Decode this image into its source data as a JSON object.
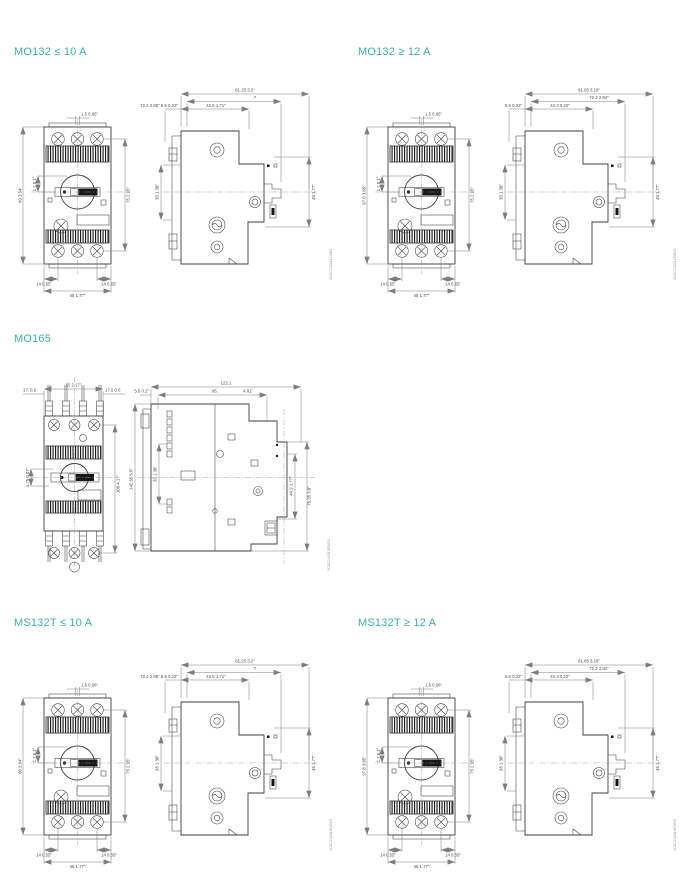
{
  "page": {
    "background": "#ffffff",
    "accent_color": "#2fb4ae",
    "drawing_line_color": "#3d3d3d",
    "dimension_line_color": "#7d7d7d",
    "dimension_text_color": "#4a4a4a"
  },
  "sections": [
    {
      "id": "mo132-le-10a",
      "title": "MO132 ≤ 10 A",
      "doc_number": "2CDC242011F0011",
      "front": {
        "knob_top": "1.5 0.06\"",
        "height_left": "90 3.54\"",
        "knob_offset": "1.7 0.1\"",
        "height_right": "75 2.95\"",
        "foot_left": "14 0.55\"",
        "foot_right": "14  0.55\"",
        "width": "45 1.77\""
      },
      "side": {
        "depth_row1": "81.25 3.2\"",
        "depth_row2": "7",
        "depth_row3_left": "72.4 2.85\" 5.5 0.22\"",
        "depth_row3_right": "43.5 1.71\"",
        "height_left": "35 1.38\"",
        "height_right": "45 1.77\""
      }
    },
    {
      "id": "mo132-ge-12a",
      "title": "MO132 ≥ 12 A",
      "doc_number": "2CDC242012F0011",
      "front": {
        "knob_top": "1.5 0.06\"",
        "height_left": "97.8 3.85\"",
        "knob_offset": "1.7 0.1\"",
        "height_right": "75 2.95\"",
        "foot_left": "14 0.55\"",
        "foot_right": "14  0.55\"",
        "width": "45 1.77\""
      },
      "side": {
        "depth_row1": "81.05 3.19\"",
        "depth_row2": "72.2 2.84\"",
        "depth_row3_left": "5.5 0.22\"",
        "depth_row3_right": "43.3 0.22\"",
        "height_left": "35 1.38\"",
        "height_right": "45 1.77\""
      }
    },
    {
      "id": "mo165",
      "title": "MO165",
      "doc_number": "2CDC242010F0014",
      "front": {
        "top_left": "17. 0.6",
        "top_center": "55 2.17\"",
        "top_right": "17.5 0.6",
        "knob_offset": "1.75 0.07\"",
        "height_right": "106 4.17\""
      },
      "side": {
        "depth_row1": "122.1",
        "depth_row2_left": "95.",
        "depth_row2_right": "4.81\"",
        "clip_top": "5.5 0.2\"",
        "height_left_outer": "142.65 5.6\"",
        "height_left_inner": "35 1.38\"",
        "height_right_inner": "44.9 1.77\"",
        "height_right_outer": "76.35 3.0\""
      }
    },
    {
      "id": "ms132t-le-10a",
      "title": "MS132T ≤ 10 A",
      "doc_number": "2CDC242011F0019",
      "front": {
        "knob_top": "1.5 0.06\"",
        "height_left": "90 3.54\"",
        "knob_offset": "1.7 0.1\"",
        "height_right": "75 2.95\"",
        "foot_left": "14 0.55\"",
        "foot_right": "14  0.55\"",
        "width": "45 1.77\""
      },
      "side": {
        "depth_row1": "81.25 3.2\"",
        "depth_row2": "7",
        "depth_row3_left": "72.4 2.85\" 5.5 0.22\"",
        "depth_row3_right": "43.5 1.71\"",
        "height_left": "35 1.38\"",
        "height_right": "45 1.77\""
      }
    },
    {
      "id": "ms132t-ge-12a",
      "title": "MS132T ≥ 12 A",
      "doc_number": "2CDC242016F0019",
      "front": {
        "knob_top": "1.5 0.06\"",
        "height_left": "97.8 3.85\"",
        "knob_offset": "1.7 0.1\"",
        "height_right": "75 2.95\"",
        "foot_left": "14 0.55\"",
        "foot_right": "14  0.55\"",
        "width": "45 1.77\""
      },
      "side": {
        "depth_row1": "81.05 3.19\"",
        "depth_row2": "72.2 2.84\"",
        "depth_row3_left": "5.5 0.22\"",
        "depth_row3_right": "43.3 0.22\"",
        "height_left": "35 1.38\"",
        "height_right": "45 1.77\""
      }
    }
  ]
}
